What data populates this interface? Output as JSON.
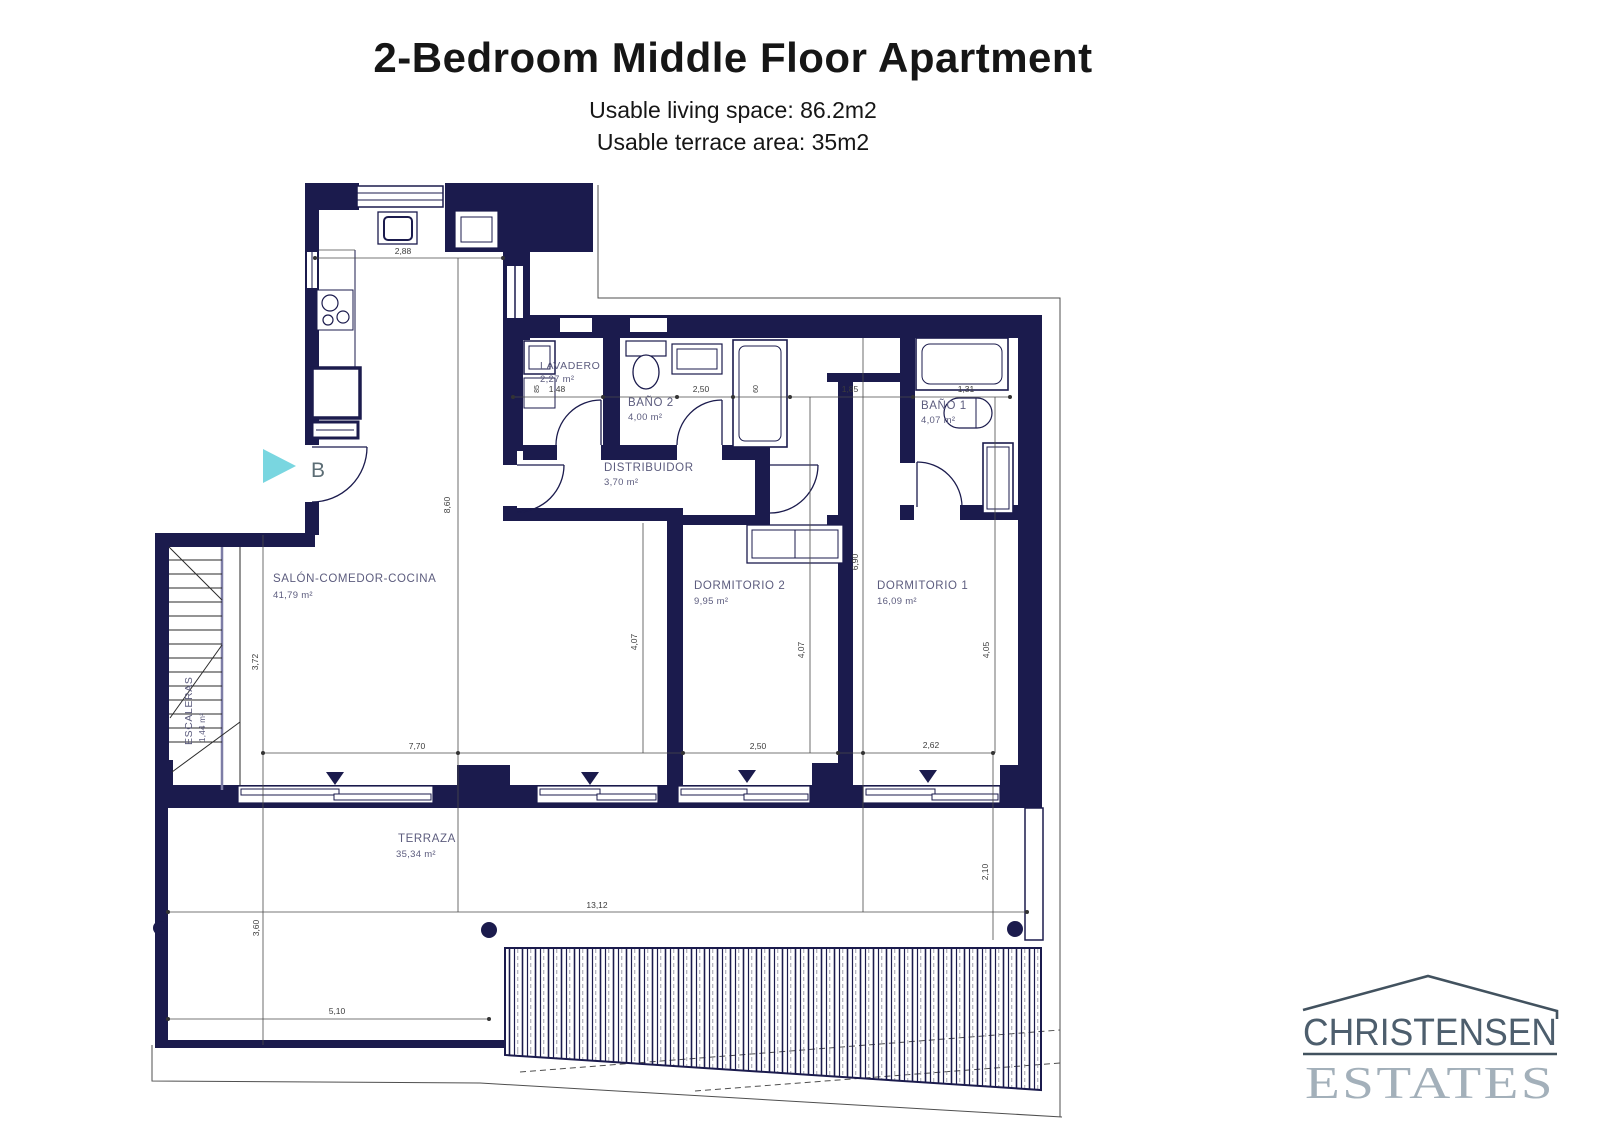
{
  "header": {
    "title": "2-Bedroom Middle Floor Apartment",
    "subtitle1": "Usable living space: 86.2m2",
    "subtitle2": "Usable terrace area: 35m2"
  },
  "plan": {
    "marker": "B",
    "rooms": {
      "lavadero": {
        "name": "LAVADERO",
        "area": "2,27 m²"
      },
      "bano2": {
        "name": "BAÑO 2",
        "area": "4,00 m²"
      },
      "bano1": {
        "name": "BAÑO 1",
        "area": "4,07 m²"
      },
      "distribuidor": {
        "name": "DISTRIBUIDOR",
        "area": "3,70 m²"
      },
      "salon": {
        "name": "SALÓN-COMEDOR-COCINA",
        "area": "41,79 m²"
      },
      "dorm2": {
        "name": "DORMITORIO 2",
        "area": "9,95 m²"
      },
      "dorm1": {
        "name": "DORMITORIO 1",
        "area": "16,09 m²"
      },
      "escaleras": {
        "name": "ESCALERAS",
        "area": "1,44 m²"
      },
      "terraza": {
        "name": "TERRAZA",
        "area": "35,34 m²"
      }
    },
    "dims": {
      "k288": "2,88",
      "k148": "1,48",
      "k250top": "2,50",
      "k185": "1,85",
      "k131": "1,31",
      "k85": "85",
      "k60": "60",
      "k860": "8,60",
      "k690": "6,90",
      "k407l": "4,07",
      "k407r": "4,07",
      "k405": "4,05",
      "k372": "3,72",
      "k770": "7,70",
      "k250bot": "2,50",
      "k262": "2,62",
      "k1312": "13,12",
      "k360": "3,60",
      "k210": "2,10",
      "k510": "5,10"
    },
    "colors": {
      "wall": "#1b1b4d",
      "arrow": "#79d6e0",
      "label": "#5c5c7e"
    }
  },
  "logo": {
    "line1": "CHRISTENSEN",
    "line2": "ESTATES"
  }
}
